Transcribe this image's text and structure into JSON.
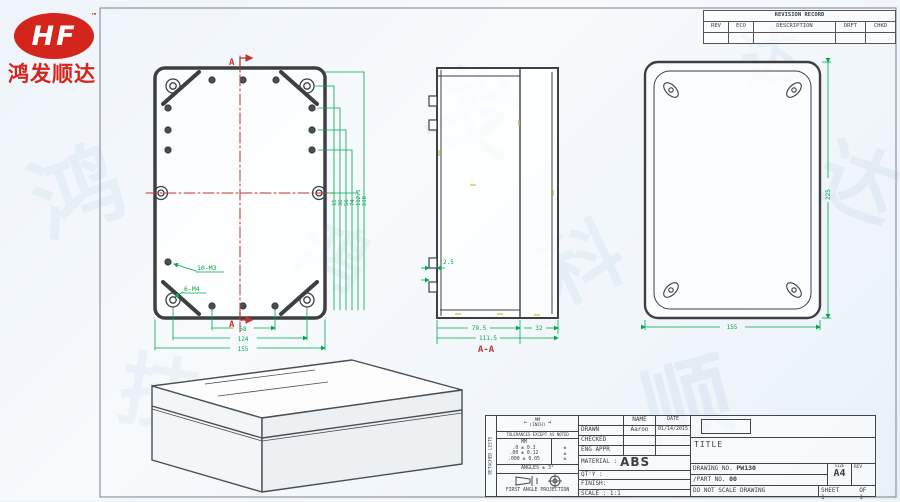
{
  "logo": {
    "brand": "HF",
    "tm": "™",
    "company": "鸿发顺达"
  },
  "watermark": {
    "chars": [
      "鸿",
      "发",
      "顺",
      "达",
      "科",
      "技",
      "鸿",
      "达"
    ]
  },
  "revision_table": {
    "title": "REVISION RECORD",
    "headers": [
      "REV",
      "ECO",
      "DESCRIPTION",
      "DRFT",
      "CHKD"
    ]
  },
  "top_view": {
    "section_label_top": "A",
    "section_label_bottom": "A",
    "callout_m3": "10-M3",
    "callout_m4": "6-M4",
    "dims_bottom": [
      "58",
      "124",
      "155"
    ],
    "dims_right": [
      "15",
      "36",
      "56",
      "74",
      "112.5",
      "210"
    ]
  },
  "section_view": {
    "label": "A-A",
    "dim_tab": "2.5",
    "dim_body": "79.5",
    "dim_total": "111.5",
    "dim_lid": "32"
  },
  "back_view": {
    "dim_height": "225",
    "dim_width": "155"
  },
  "title_block": {
    "side_label": "DETACHED LISTS",
    "units_top": "MM",
    "units_bottom": "(INCH)",
    "arrow_left": "←",
    "arrow_right": "→",
    "tolerances_note": "TOLERANCES EXCEPT AS NOTED",
    "tol_header": "MM",
    "tol_rows": [
      ".0 ± 0.3",
      ".00 ± 0.12",
      ".000 ± 0.05"
    ],
    "tol_marks": [
      "±",
      "±",
      "±"
    ],
    "angles": "ANGLES ± 3°",
    "projection": "FIRST ANGLE PROJECTION",
    "name_header": "NAME",
    "date_header": "DATE",
    "drawn_label": "DRAWN",
    "drawn_name": "Aaron",
    "drawn_date": "01/14/2015",
    "checked_label": "CHECKED",
    "eng_appr_label": "ENG APPR",
    "material_label": "MATERIAL :",
    "material_value": "ABS",
    "qty_label": "QT'Y :",
    "finish_label": "FINISH:",
    "scale_label": "SCALE : 1:1",
    "title_label": "TITLE",
    "drawing_no_label": "DRAWING NO.",
    "drawing_no": "PW130",
    "part_no_label": "/PART NO.",
    "part_no": "00",
    "size_label": "SIZE",
    "size_value": "A4",
    "rev_label": "REV",
    "do_not_scale": "DO NOT SCALE DRAWING",
    "sheet_label": "SHEET 1",
    "of_label": "OF 1"
  },
  "colors": {
    "dim_green": "#00a84a",
    "center_red": "#c2332f",
    "line_dark": "#3c4043",
    "logo_red": "#d4251c",
    "tick_yellow": "#d8c44a"
  }
}
